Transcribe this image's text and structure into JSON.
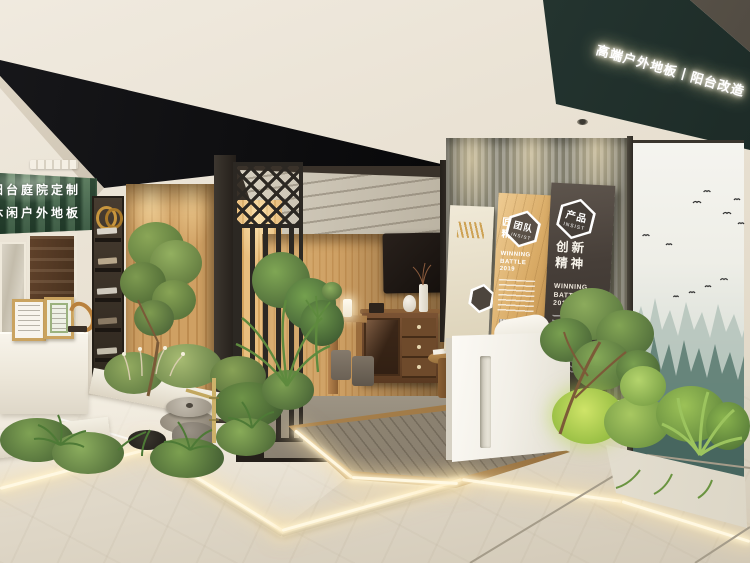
{
  "scene": {
    "alt": "3D interior render of a wood-flooring brand showroom: black canopy entrance, zen garden with millstone fountain and bamboo spout, timber lounge room, culture sign panels and a misty forest mural"
  },
  "signs": {
    "fascia_led": "高端户外地板丨阳台改造",
    "banner_line1": "阳台庭院定制",
    "banner_line2": "休闲户外地板"
  },
  "panels": {
    "team": {
      "badge": "团队",
      "badge_sub": "INSIST",
      "heading_line1": "匠心",
      "heading_line2": "精神",
      "award_line1": "WINNING",
      "award_line2": "BATTLE",
      "award_line3": "2019"
    },
    "product": {
      "badge": "产品",
      "badge_sub": "INSIST",
      "heading_line1": "创新",
      "heading_line2": "精神",
      "award_line1": "WINNING",
      "award_line2": "BATTLE",
      "award_line3": "2019"
    }
  },
  "colors": {
    "fascia_teal": "#2b3b37",
    "canopy_black": "#0a0a0c",
    "oak_wood": "#c89a5f",
    "walnut": "#6e4a2e",
    "slat_wall_grey": "#8d8a7c",
    "marble_floor": "#e0d9ca",
    "led_glow": "#fff6dd",
    "forest_mural": "#5f7f75",
    "foliage_green": "#6a9440"
  }
}
